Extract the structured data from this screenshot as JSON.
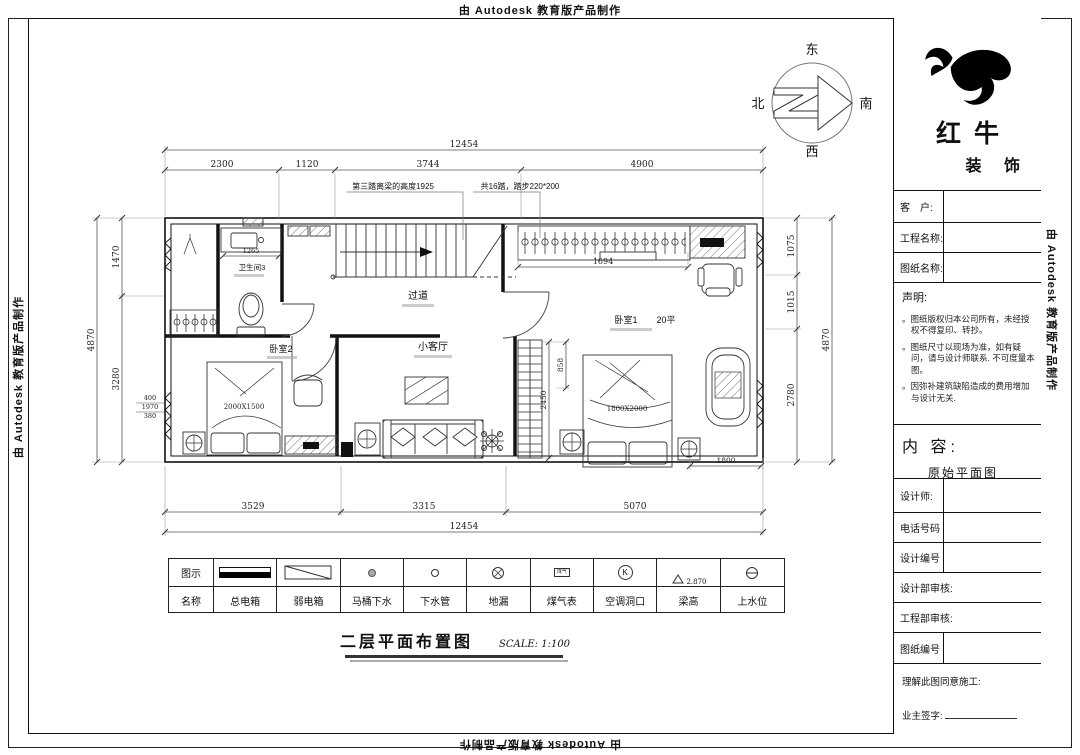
{
  "stamp": "由 Autodesk 教育版产品制作",
  "compass": {
    "east": "东",
    "south": "南",
    "west": "西",
    "north": "北"
  },
  "plan": {
    "rooms": {
      "bathroom": "卫生间3",
      "corridor": "过道",
      "bedroom2": "卧室2",
      "living": "小客厅",
      "bedroom1": "卧室1",
      "bedroom1_area": "20平",
      "bed2_size": "2000X1500",
      "bed1_size": "1800X2000"
    },
    "annotations": {
      "stair_note_1": "第三踏离梁的高度1925",
      "stair_note_2": "共16踏，踏步220*200"
    },
    "dims": {
      "h_total": "12454",
      "top_segments": [
        "2300",
        "1120",
        "3744",
        "4900"
      ],
      "bottom_segments": [
        "3529",
        "3315",
        "5070"
      ],
      "left_total": "4870",
      "left_segments": [
        "1470",
        "3280"
      ],
      "left_stack": [
        "400",
        "1970",
        "380"
      ],
      "right_total": "4870",
      "right_segments": [
        "1075",
        "1015",
        "2780"
      ],
      "wardrobe_width": "1694",
      "ladder_height": "2450",
      "gap": "858",
      "dim_1800": "1800",
      "sink_width": "1265"
    }
  },
  "legend": {
    "row_symbol_label": "图示",
    "row_name_label": "名称",
    "items": [
      {
        "name": "总电箱"
      },
      {
        "name": "弱电箱"
      },
      {
        "name": "马桶下水"
      },
      {
        "name": "下水管"
      },
      {
        "name": "地漏"
      },
      {
        "name": "煤气表",
        "symbol_text": "煤气"
      },
      {
        "name": "空调洞口",
        "symbol_text": "K"
      },
      {
        "name": "梁高",
        "symbol_text": "2.870"
      },
      {
        "name": "上水位"
      }
    ]
  },
  "drawing_title": {
    "text": "二层平面布置图",
    "scale": "SCALE: 1:100"
  },
  "title_block": {
    "company_name_1": "红牛",
    "company_name_2": "装 饰",
    "rows": {
      "client": "客　户:",
      "project_name": "工程名称:",
      "drawing_name": "图纸名称:",
      "designer": "设计师:",
      "phone": "电话号码",
      "design_no": "设计编号",
      "design_dept_review": "设计部审核:",
      "eng_dept_review": "工程部审核:",
      "drawing_no": "图纸编号"
    },
    "statement_title": "声明:",
    "statement_items": [
      "。图纸版权归本公司所有，未经授权不得复印、转抄。",
      "。图纸尺寸以现场为准，如有疑问，请与设计师联系. 不可度量本图。",
      "。因弥补建筑缺陷造成的费用增加与设计无关."
    ],
    "content_label": "内 容:",
    "content_value": "原始平面图",
    "agreement": "理解此图同意施工:",
    "owner_sign": "业主签字:"
  }
}
